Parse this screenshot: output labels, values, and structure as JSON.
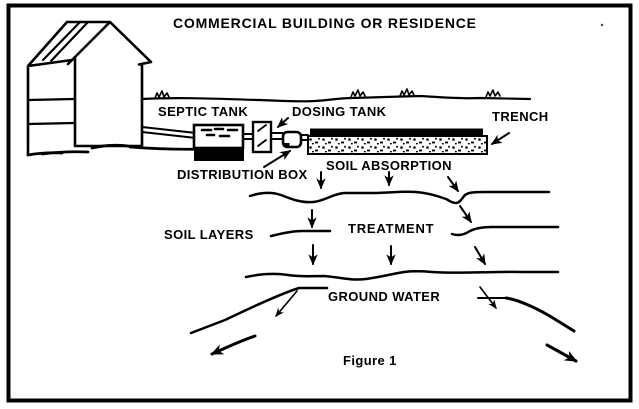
{
  "title": "COMMERCIAL BUILDING OR RESIDENCE",
  "caption": "Figure 1",
  "labels": {
    "septic_tank": "SEPTIC TANK",
    "dosing_tank": "DOSING TANK",
    "trench": "TRENCH",
    "distribution_box": "DISTRIBUTION BOX",
    "soil_absorption": "SOIL ABSORPTION",
    "soil_layers": "SOIL LAYERS",
    "treatment": "TREATMENT",
    "ground_water": "GROUND WATER"
  },
  "colors": {
    "ink": "#000000",
    "background": "#ffffff"
  }
}
